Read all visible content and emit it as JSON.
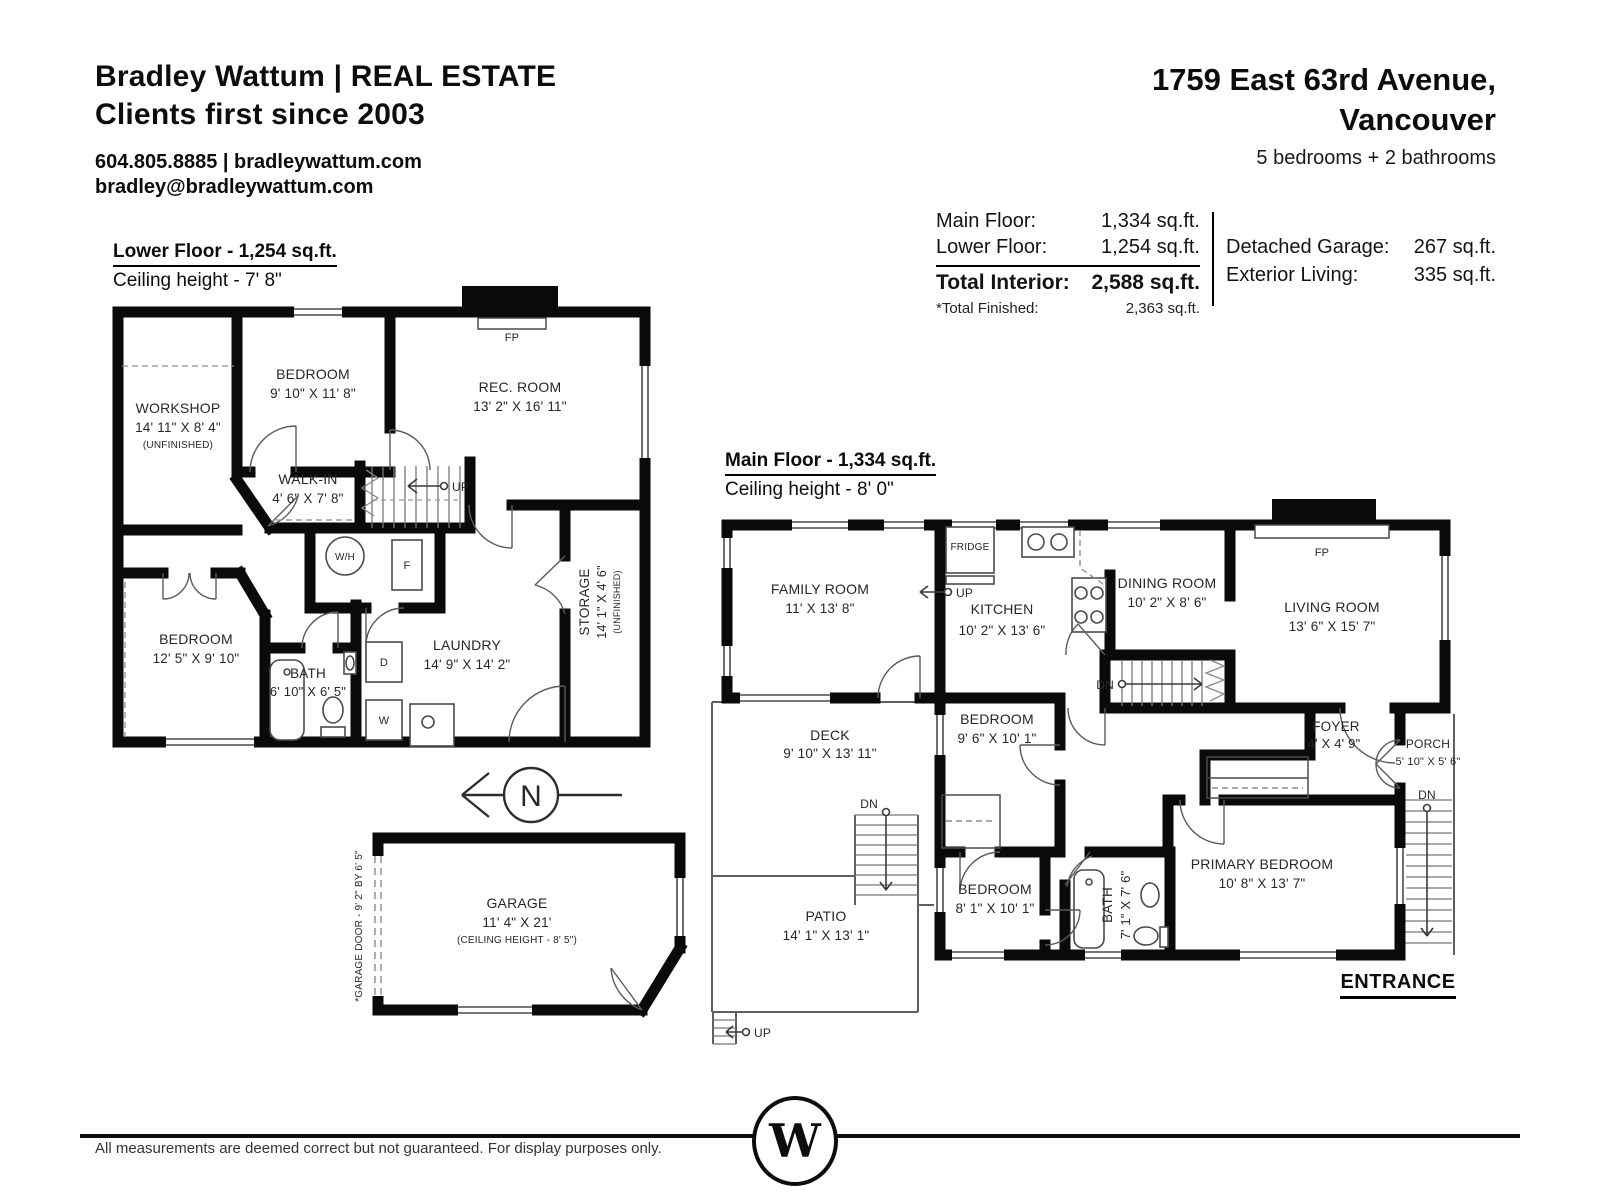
{
  "header": {
    "brand_line1": "Bradley Wattum | REAL ESTATE",
    "brand_line2": "Clients first since 2003",
    "contact_line1": "604.805.8885 | bradleywattum.com",
    "contact_line2": "bradley@bradleywattum.com",
    "address_line1": "1759 East 63rd Avenue,",
    "address_line2": "Vancouver",
    "summary": "5 bedrooms + 2 bathrooms"
  },
  "stats": {
    "rows": [
      {
        "label": "Main Floor:",
        "value": "1,334 sq.ft."
      },
      {
        "label": "Lower Floor:",
        "value": "1,254 sq.ft."
      },
      {
        "label": "Total Interior:",
        "value": "2,588 sq.ft."
      },
      {
        "label": "*Total Finished:",
        "value": "2,363 sq.ft."
      }
    ],
    "right_rows": [
      {
        "label": "Detached Garage:",
        "value": "267 sq.ft."
      },
      {
        "label": "Exterior Living:",
        "value": "335 sq.ft."
      }
    ]
  },
  "floors": {
    "lower": {
      "title": "Lower Floor - 1,254 sq.ft.",
      "ceiling": "Ceiling height - 7' 8\"",
      "rooms": {
        "workshop": {
          "name": "WORKSHOP",
          "dims": "14' 11\" X 8' 4\"",
          "note": "(UNFINISHED)"
        },
        "bedroom_top": {
          "name": "BEDROOM",
          "dims": "9' 10\" X 11' 8\""
        },
        "rec_room": {
          "name": "REC. ROOM",
          "dims": "13' 2\" X 16' 11\""
        },
        "walk_in": {
          "name": "WALK-IN",
          "dims": "4' 6\" X 7' 8\""
        },
        "bedroom_low": {
          "name": "BEDROOM",
          "dims": "12' 5\" X 9' 10\""
        },
        "bath": {
          "name": "BATH",
          "dims": "6' 10\" X 6' 5\""
        },
        "laundry": {
          "name": "LAUNDRY",
          "dims": "14' 9\" X 14' 2\""
        },
        "storage": {
          "name": "STORAGE",
          "dims": "14' 1\" X 4' 6\"",
          "note": "(UNFINISHED)"
        }
      }
    },
    "main": {
      "title": "Main Floor - 1,334 sq.ft.",
      "ceiling": "Ceiling height - 8' 0\"",
      "rooms": {
        "family": {
          "name": "FAMILY ROOM",
          "dims": "11' X 13' 8\""
        },
        "kitchen": {
          "name": "KITCHEN",
          "dims": "10' 2\" X 13' 6\""
        },
        "dining": {
          "name": "DINING ROOM",
          "dims": "10' 2\" X 8' 6\""
        },
        "living": {
          "name": "LIVING ROOM",
          "dims": "13' 6\" X 15' 7\""
        },
        "deck": {
          "name": "DECK",
          "dims": "9' 10\" X 13' 11\""
        },
        "bedroom1": {
          "name": "BEDROOM",
          "dims": "9' 6\" X 10' 1\""
        },
        "bedroom2": {
          "name": "BEDROOM",
          "dims": "8' 1\" X 10' 1\""
        },
        "bath": {
          "name": "BATH",
          "dims": "7' 1\" X 7' 6\""
        },
        "primary": {
          "name": "PRIMARY BEDROOM",
          "dims": "10' 8\" X 13' 7\""
        },
        "foyer": {
          "name": "FOYER",
          "dims": "4' X 4' 9\""
        },
        "porch": {
          "name": "PORCH",
          "dims": "5' 10\" X 5' 6\""
        },
        "patio": {
          "name": "PATIO",
          "dims": "14' 1\" X 13' 1\""
        },
        "garage": {
          "name": "GARAGE",
          "dims": "11' 4\" X 21'",
          "note": "(CEILING HEIGHT - 8' 5\")",
          "door_note": "*GARAGE DOOR - 9' 2\" BY 6' 5\""
        }
      }
    }
  },
  "markers": {
    "up": "UP",
    "dn": "DN",
    "fp": "FP",
    "north": "N",
    "entrance": "ENTRANCE",
    "fridge": "FRIDGE",
    "washer": "W",
    "dryer": "D",
    "water_heater": "W/H",
    "furnace": "F"
  },
  "footer": {
    "disclaimer": "All measurements are deemed correct but not guaranteed. For display purposes only.",
    "logo_letter": "W"
  }
}
